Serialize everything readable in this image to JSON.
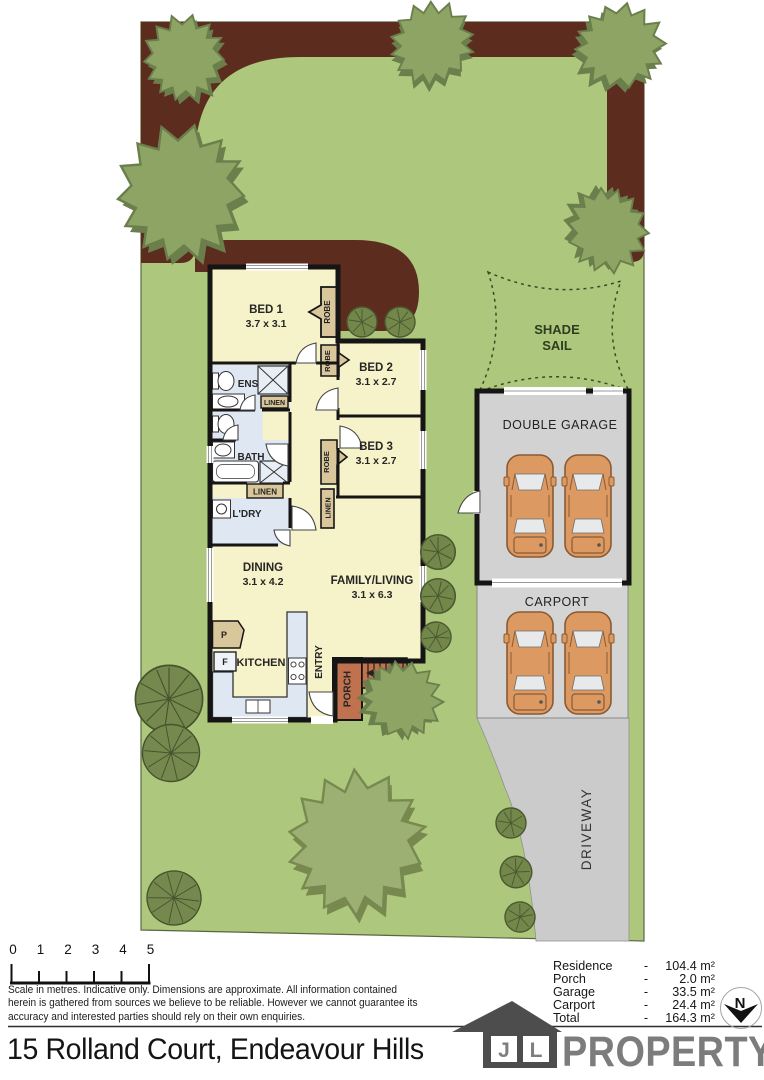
{
  "colors": {
    "lawn": "#adc87c",
    "garden_bed": "#5c2c1e",
    "floor": "#f6f2c9",
    "wet_area": "#dfe8f2",
    "joinery_tan": "#d9c79b",
    "wall": "#151515",
    "garage_fill": "#d2d2d2",
    "carport_fill": "#d4d4d4",
    "driveway_fill": "#cbcbcb",
    "porch": "#c0714d",
    "car": "#dc9a62",
    "tree": "#8ea465",
    "tree_dark": "#6b7f4c"
  },
  "plan": {
    "bed1_name": "BED 1",
    "bed1_dims": "3.7 x 3.1",
    "bed2_name": "BED 2",
    "bed2_dims": "3.1 x 2.7",
    "bed3_name": "BED 3",
    "bed3_dims": "3.1 x 2.7",
    "dining_name": "DINING",
    "dining_dims": "3.1 x 4.2",
    "family_name": "FAMILY/LIVING",
    "family_dims": "3.1 x 6.3",
    "kitchen": "KITCHEN",
    "entry": "ENTRY",
    "porch": "PORCH",
    "ens": "ENS",
    "bath": "BATH",
    "laundry": "L'DRY",
    "robe": "ROBE",
    "linen": "LINEN",
    "pantry_abbr": "P",
    "fridge_abbr": "F",
    "shade_sail_line1": "SHADE",
    "shade_sail_line2": "SAIL",
    "double_garage": "DOUBLE GARAGE",
    "carport": "CARPORT",
    "driveway": "DRIVEWAY"
  },
  "scale_bar": {
    "ticks": [
      "0",
      "1",
      "2",
      "3",
      "4",
      "5"
    ]
  },
  "disclaimer": {
    "line1": "Scale in metres. Indicative only. Dimensions are approximate. All information contained",
    "line2": "herein is gathered from sources we believe to be reliable. However we cannot guarantee its",
    "line3": "accuracy and interested parties should rely on their own enquiries."
  },
  "areas": {
    "dash": "-",
    "rows": [
      {
        "label": "Residence",
        "value": "104.4 m²"
      },
      {
        "label": "Porch",
        "value": "2.0 m²"
      },
      {
        "label": "Garage",
        "value": "33.5 m²"
      },
      {
        "label": "Carport",
        "value": "24.4 m²"
      },
      {
        "label": "Total",
        "value": "164.3 m²"
      }
    ]
  },
  "north_label": "N",
  "footer": {
    "address": "15 Rolland Court, Endeavour Hills",
    "logo_letter_j": "J",
    "logo_letter_l": "L",
    "logo_wordmark": "PROPERTY"
  }
}
